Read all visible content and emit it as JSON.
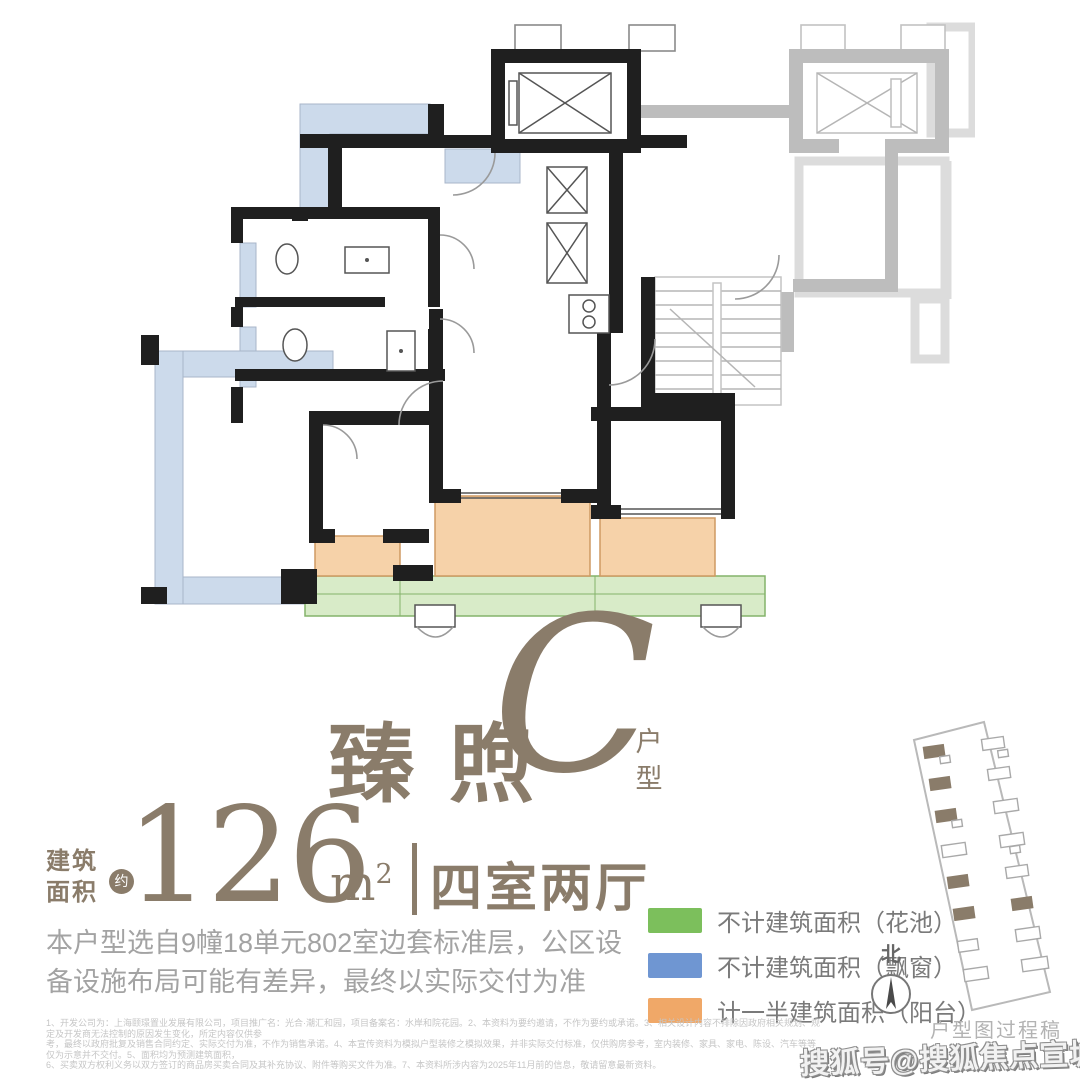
{
  "colors": {
    "taupe": "#8a7c6a",
    "body_gray": "#a3a3a3",
    "legend_text": "#7a7a7a",
    "legend_green": "#7cbf5c",
    "legend_blue": "#6f96d2",
    "legend_orange": "#f0a868",
    "plan_black": "#1f1f1f",
    "plan_gray": "#bdbdbd",
    "plan_ghost": "#dcdcdc",
    "fill_blue": "#ccdaeb",
    "fill_orange": "#f6d2a9",
    "fill_green": "#d8ebc8",
    "green_edge": "#84b36a",
    "fineprint_gray": "#c6c6c6",
    "draft_gray": "#b3b3b3"
  },
  "title": {
    "name_cn": "臻煦",
    "type_letter": "C",
    "type_suffix_1": "户",
    "type_suffix_2": "型"
  },
  "area": {
    "label_line1": "建筑",
    "label_line2": "面积",
    "approx_badge": "约",
    "value": "126",
    "unit": "m",
    "unit_sup": "2",
    "layout": "四室两厅"
  },
  "description": {
    "line1": "本户型选自9幢18单元802室边套标准层，公区设",
    "line2": "备设施布局可能有差异，最终以实际交付为准"
  },
  "legend": {
    "items": [
      {
        "name": "flower-bed",
        "label": "不计建筑面积（花池）"
      },
      {
        "name": "bay-window",
        "label": "不计建筑面积（飘窗）"
      },
      {
        "name": "balcony",
        "label": "计一半建筑面积（阳台）"
      }
    ]
  },
  "compass": {
    "north_label": "北"
  },
  "footer": {
    "draft_note": "户型图过程稿",
    "watermark": "搜狐号@搜狐焦点宣城站",
    "disclaimer_line1": "1、开发公司为：上海颐璟置业发展有限公司，项目推广名：光合·潮汇和园，项目备案名：水岸和院花园。2、本资料为要约邀请，不作为要约或承诺。3、相关设计内容不排除因政府相关规划、规定及开发商无法控制的原因发生变化，所定内容仅供参",
    "disclaimer_line2": "考，最终以政府批复及销售合同约定、实际交付为准，不作为销售承诺。4、本宣传资料为模拟户型装修之模拟效果，并非实际交付标准，仅供购房参考，室内装修、家具、家电、陈设、汽车等等仅为示意并不交付。5、面积均为预测建筑面积，",
    "disclaimer_line3": "6、买卖双方权利义务以双方签订的商品房买卖合同及其补充协议、附件等购买文件为准。7、本资料所涉内容为2025年11月前的信息，敬请留意最新资料。"
  }
}
